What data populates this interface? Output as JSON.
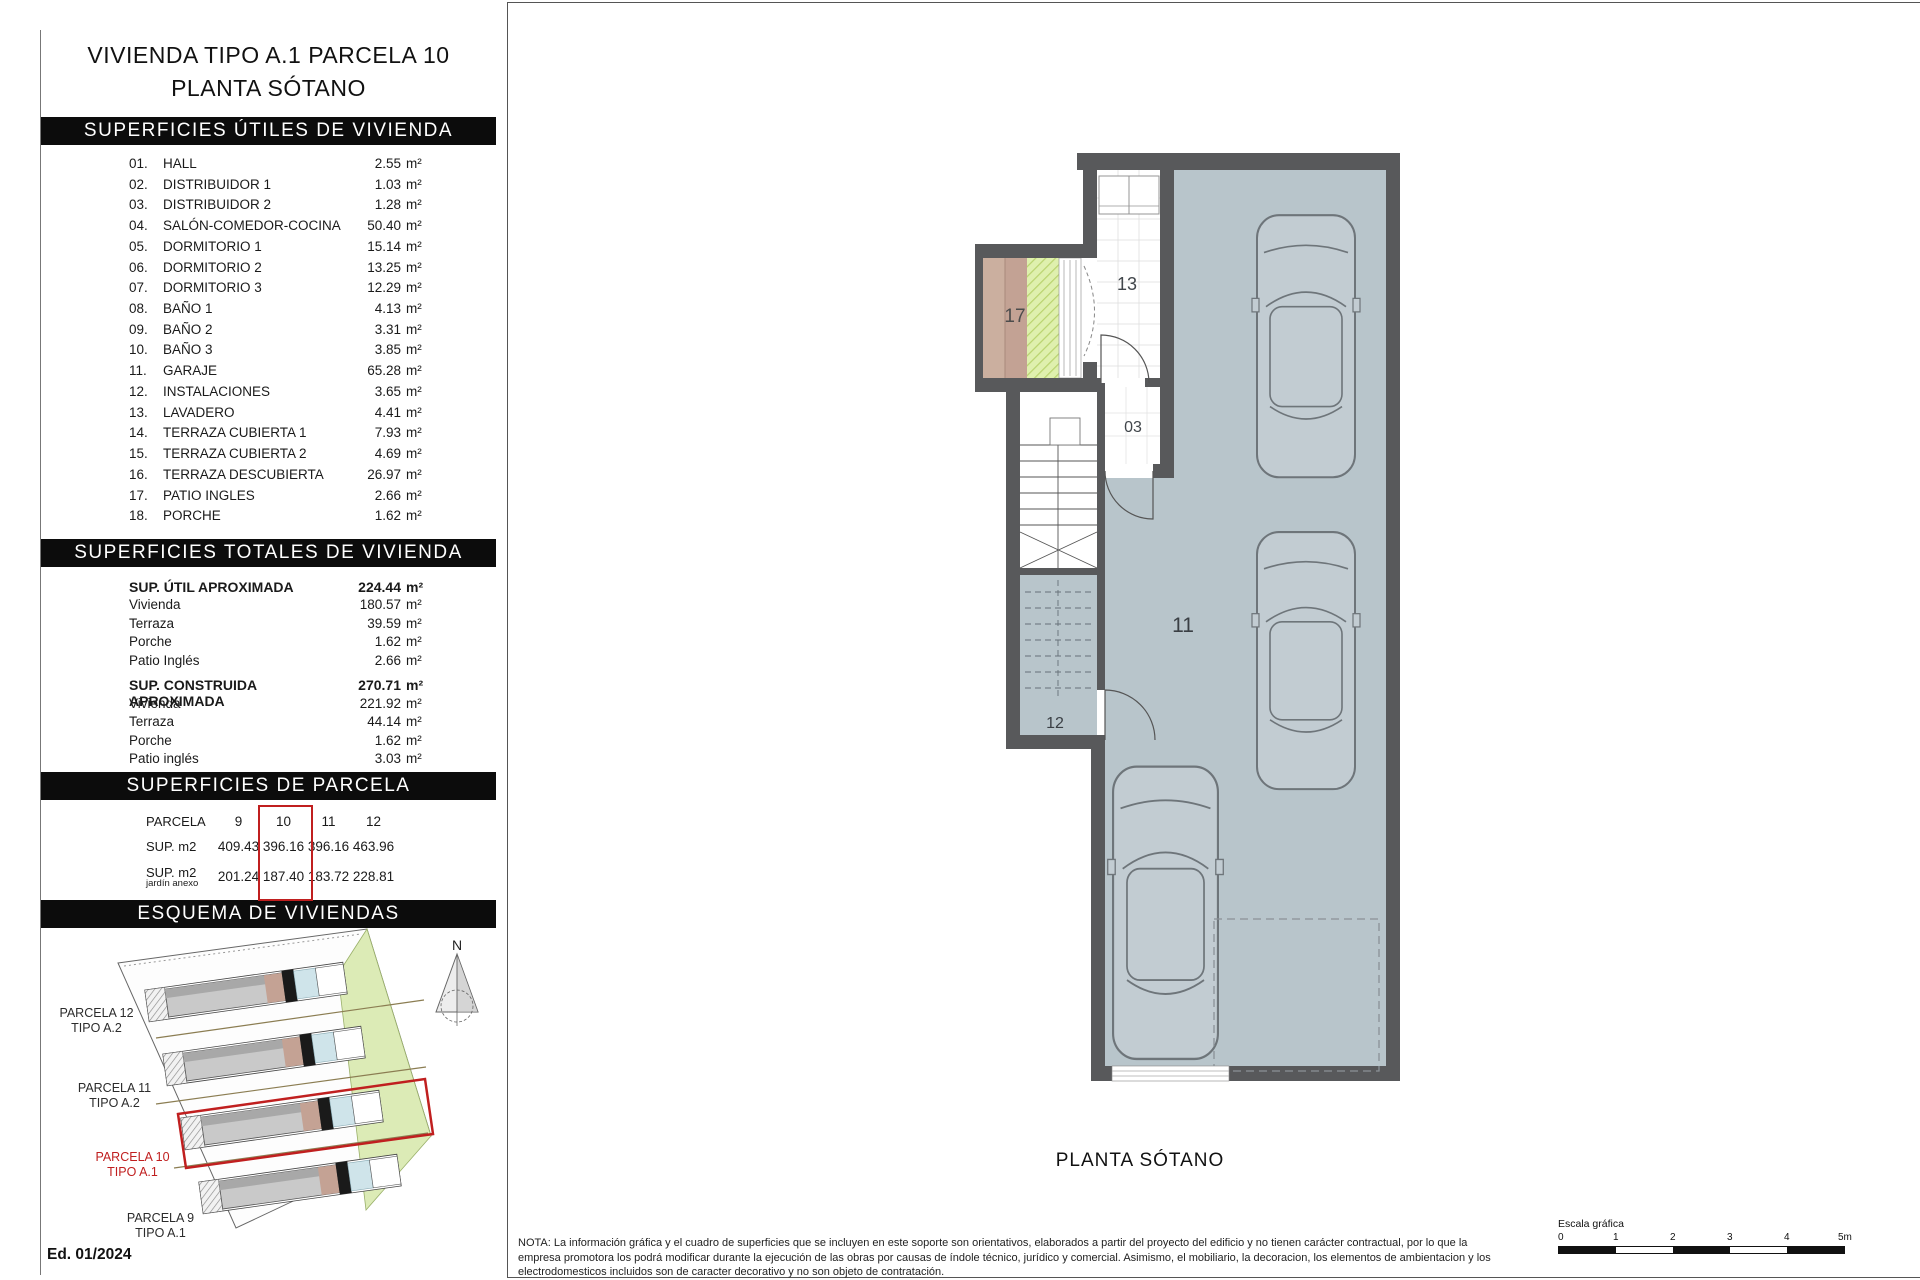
{
  "panel": {
    "title_line1": "VIVIENDA TIPO A.1 PARCELA 10",
    "title_line2": "PLANTA SÓTANO",
    "useful": {
      "header": "SUPERFICIES ÚTILES DE VIVIENDA",
      "unit": "m²",
      "rooms": [
        {
          "num": "01.",
          "label": "HALL",
          "value": "2.55"
        },
        {
          "num": "02.",
          "label": "DISTRIBUIDOR 1",
          "value": "1.03"
        },
        {
          "num": "03.",
          "label": "DISTRIBUIDOR 2",
          "value": "1.28"
        },
        {
          "num": "04.",
          "label": "SALÓN-COMEDOR-COCINA",
          "value": "50.40"
        },
        {
          "num": "05.",
          "label": "DORMITORIO 1",
          "value": "15.14"
        },
        {
          "num": "06.",
          "label": "DORMITORIO 2",
          "value": "13.25"
        },
        {
          "num": "07.",
          "label": "DORMITORIO 3",
          "value": "12.29"
        },
        {
          "num": "08.",
          "label": "BAÑO 1",
          "value": "4.13"
        },
        {
          "num": "09.",
          "label": "BAÑO 2",
          "value": "3.31"
        },
        {
          "num": "10.",
          "label": "BAÑO 3",
          "value": "3.85"
        },
        {
          "num": "11.",
          "label": "GARAJE",
          "value": "65.28"
        },
        {
          "num": "12.",
          "label": "INSTALACIONES",
          "value": "3.65"
        },
        {
          "num": "13.",
          "label": "LAVADERO",
          "value": "4.41"
        },
        {
          "num": "14.",
          "label": "TERRAZA CUBIERTA 1",
          "value": "7.93"
        },
        {
          "num": "15.",
          "label": "TERRAZA CUBIERTA 2",
          "value": "4.69"
        },
        {
          "num": "16.",
          "label": "TERRAZA DESCUBIERTA",
          "value": "26.97"
        },
        {
          "num": "17.",
          "label": "PATIO INGLES",
          "value": "2.66"
        },
        {
          "num": "18.",
          "label": "PORCHE",
          "value": "1.62"
        }
      ]
    },
    "totals": {
      "header": "SUPERFICIES TOTALES DE VIVIENDA",
      "unit": "m²",
      "groups": [
        {
          "label": "SUP. ÚTIL APROXIMADA",
          "value": "224.44",
          "rows": [
            {
              "label": "Vivienda",
              "value": "180.57"
            },
            {
              "label": "Terraza",
              "value": "39.59"
            },
            {
              "label": "Porche",
              "value": "1.62"
            },
            {
              "label": "Patio Inglés",
              "value": "2.66"
            }
          ]
        },
        {
          "label": "SUP. CONSTRUIDA APROXIMADA",
          "value": "270.71",
          "rows": [
            {
              "label": "Vivienda",
              "value": "221.92"
            },
            {
              "label": "Terraza",
              "value": "44.14"
            },
            {
              "label": "Porche",
              "value": "1.62"
            },
            {
              "label": "Patio inglés",
              "value": "3.03"
            }
          ]
        }
      ]
    },
    "parcela": {
      "header": "SUPERFICIES DE PARCELA",
      "row1_label": "PARCELA",
      "cols": [
        "9",
        "10",
        "11",
        "12"
      ],
      "row2_label": "SUP. m2",
      "sup": [
        "409.43",
        "396.16",
        "396.16",
        "463.96"
      ],
      "row3_label": "SUP. m2",
      "row3_sublabel": "jardín anexo",
      "jardin": [
        "201.24",
        "187.40",
        "183.72",
        "228.81"
      ],
      "highlighted_col": "10"
    },
    "esquema": {
      "header": "ESQUEMA DE VIVIENDAS",
      "north_label": "N",
      "parcelas": [
        {
          "name": "PARCELA 12",
          "tipo": "TIPO A.2"
        },
        {
          "name": "PARCELA 11",
          "tipo": "TIPO A.2"
        },
        {
          "name": "PARCELA 10",
          "tipo": "TIPO A.1"
        },
        {
          "name": "PARCELA 9",
          "tipo": "TIPO A.1"
        }
      ],
      "edition": "Ed. 01/2024"
    }
  },
  "plan": {
    "caption": "PLANTA SÓTANO",
    "labels": {
      "r13": "13",
      "r17": "17",
      "r03": "03",
      "r11": "11",
      "r12": "12"
    }
  },
  "footer": {
    "note_lines": [
      "NOTA: La información gráfica y el cuadro de superficies que se incluyen en este soporte son orientativos, elaborados a partir del proyecto del edificio y no tienen carácter contractual, por lo que la",
      "empresa promotora los podrá modificar durante la ejecución de las obras por causas de índole técnico, jurídico y comercial. Asimismo, el mobiliario, la decoracion, los elementos de ambientacion y los",
      "electrodomesticos incluidos son de caracter decorativo y no son objeto de contratación."
    ],
    "scale_label": "Escala gráfica",
    "scale_ticks": [
      "0",
      "1",
      "2",
      "3",
      "4",
      "5m"
    ]
  },
  "colors": {
    "accent_red": "#c01f1f",
    "wall_gray": "#58595b",
    "garage_floor": "#b8c5cb",
    "garden_green": "#dcebb6",
    "patio_tan": "#cbaf9f",
    "hatch_green": "#dff0ae",
    "detail_blue": "#cfe4ea"
  }
}
